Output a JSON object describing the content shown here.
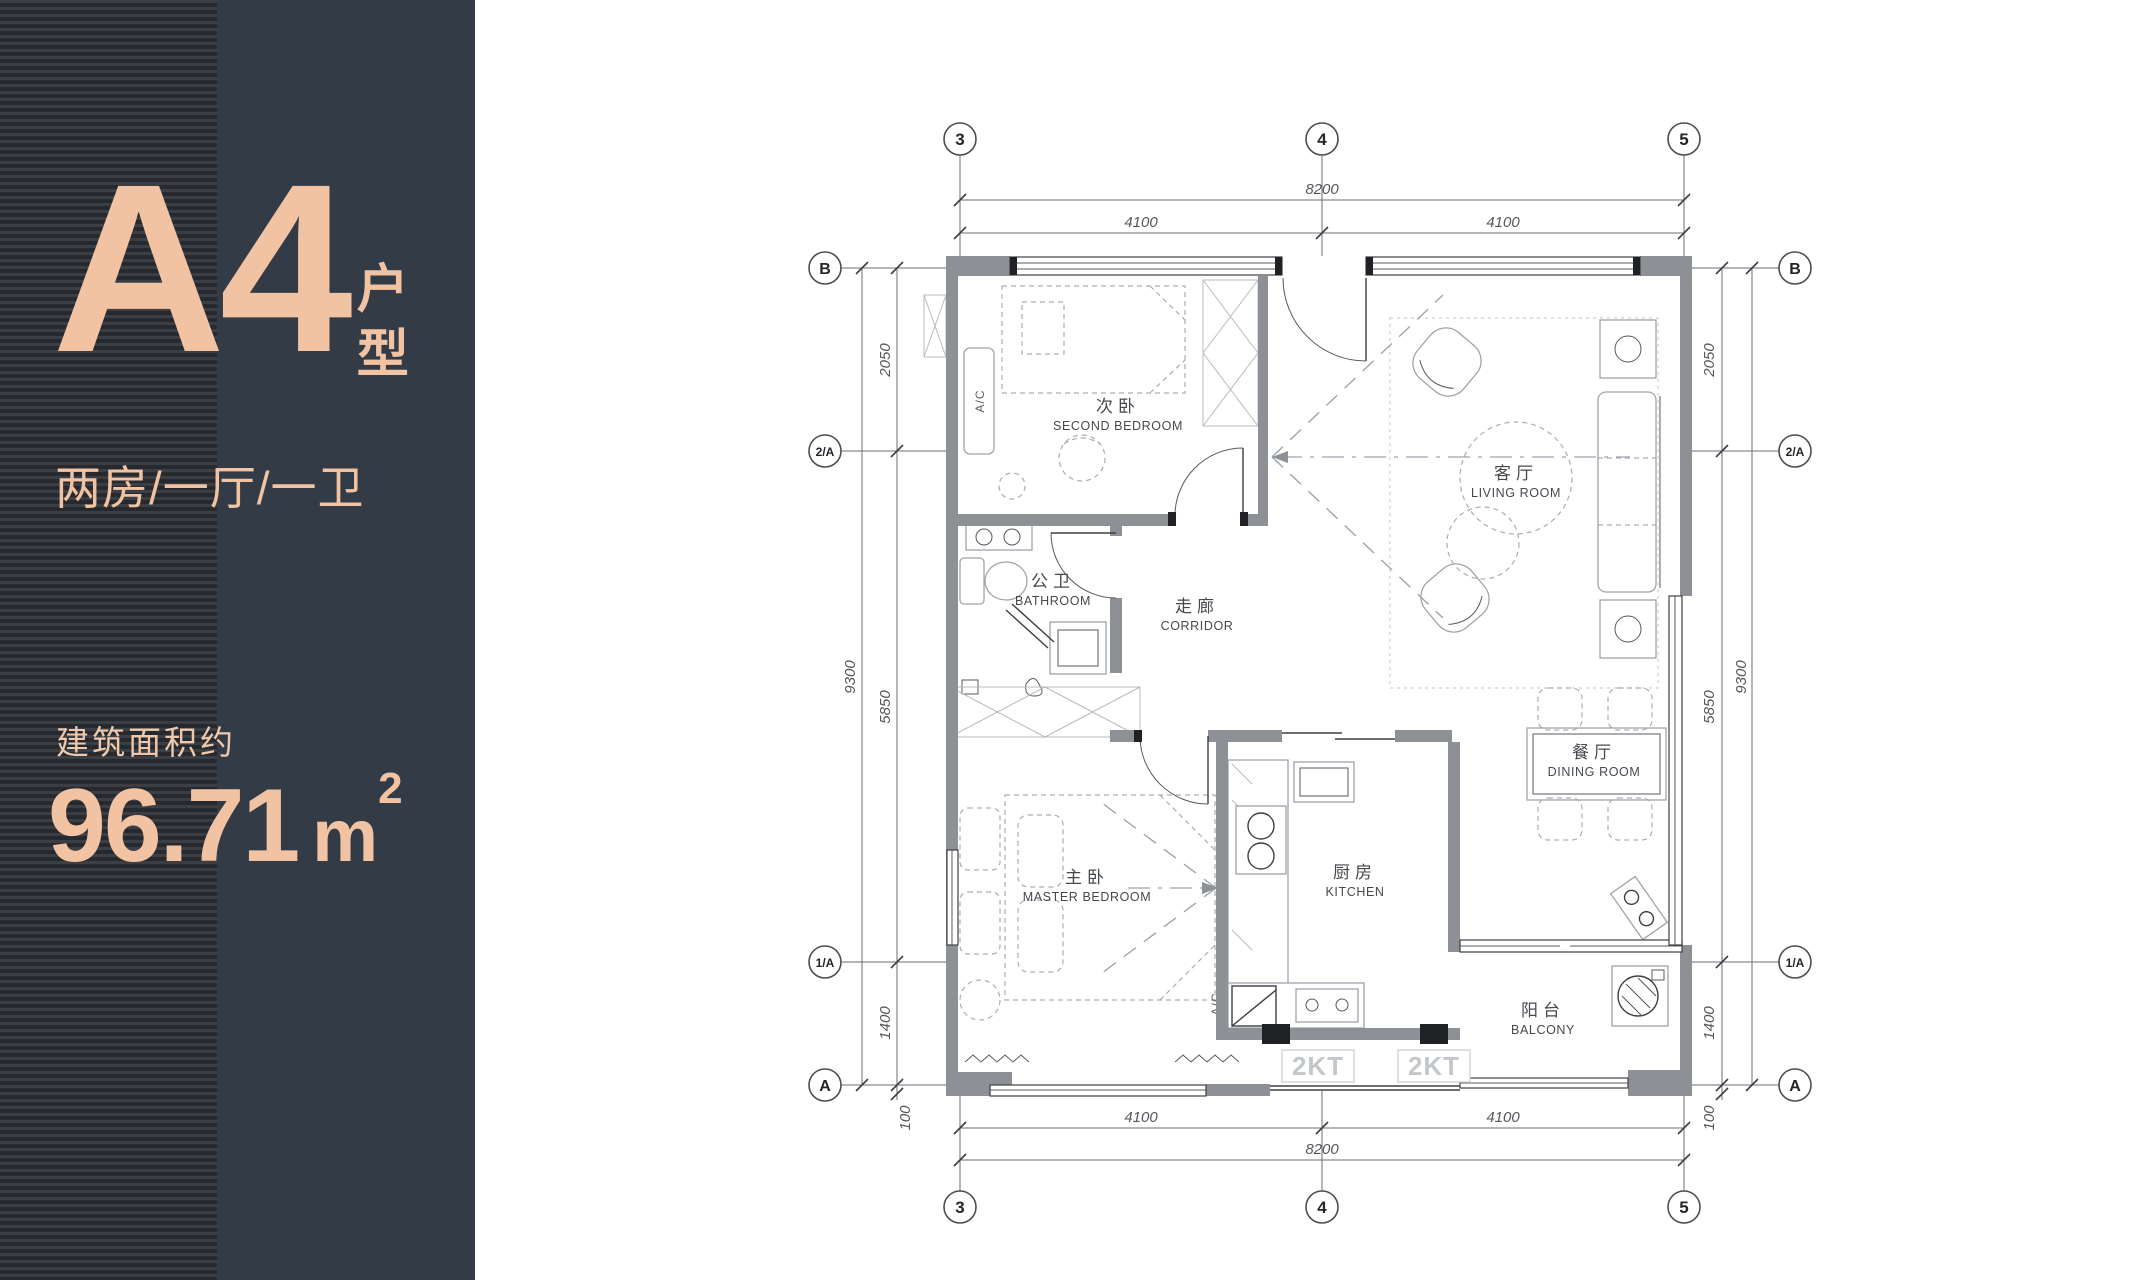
{
  "sidebar": {
    "unit_name": "A4",
    "unit_suffix": "户型",
    "layout_text": "两房/一厅/一卫",
    "area_caption": "建筑面积约",
    "area_value": "96.71",
    "area_unit": "m",
    "area_exponent": "2"
  },
  "colors": {
    "sidebar_solid": "#333b46",
    "sidebar_stripe_light": "#3b3e44",
    "sidebar_stripe_dark": "#26292e",
    "accent_text": "#f2c3a2",
    "plan_background": "#ffffff",
    "wall_gray": "#8d9095",
    "line_dark": "#3c3f43",
    "furniture_line": "#a9adb3"
  },
  "plan": {
    "grid": {
      "cols_top": [
        "3",
        "4",
        "5"
      ],
      "cols_bottom": [
        "3",
        "4",
        "5"
      ],
      "rows_left": [
        "B",
        "2/A",
        "1/A",
        "A"
      ],
      "rows_right": [
        "B",
        "2/A",
        "1/A",
        "A"
      ]
    },
    "dims": {
      "top_total": "8200",
      "top_left": "4100",
      "top_right": "4100",
      "bottom_left": "4100",
      "bottom_right": "4100",
      "bottom_total": "8200",
      "left_upper": "2050",
      "left_mid": "5850",
      "left_total": "9300",
      "left_lower": "1400",
      "left_offset": "100",
      "right_upper": "2050",
      "right_mid": "5850",
      "right_total": "9300",
      "right_lower": "1400",
      "right_offset": "100"
    },
    "rooms": {
      "second_bedroom": {
        "zh": "次卧",
        "en": "SECOND BEDROOM"
      },
      "living_room": {
        "zh": "客厅",
        "en": "LIVING ROOM"
      },
      "bathroom": {
        "zh": "公卫",
        "en": "BATHROOM"
      },
      "corridor": {
        "zh": "走廊",
        "en": "CORRIDOR"
      },
      "master_bedroom": {
        "zh": "主卧",
        "en": "MASTER BEDROOM"
      },
      "kitchen": {
        "zh": "厨房",
        "en": "KITCHEN"
      },
      "dining_room": {
        "zh": "餐厅",
        "en": "DINING ROOM"
      },
      "balcony": {
        "zh": "阳台",
        "en": "BALCONY"
      }
    },
    "annotations": {
      "ac_bedroom": "A/C",
      "ac_kitchen": "A/C",
      "kt_left": "2KT",
      "kt_right": "2KT"
    }
  }
}
